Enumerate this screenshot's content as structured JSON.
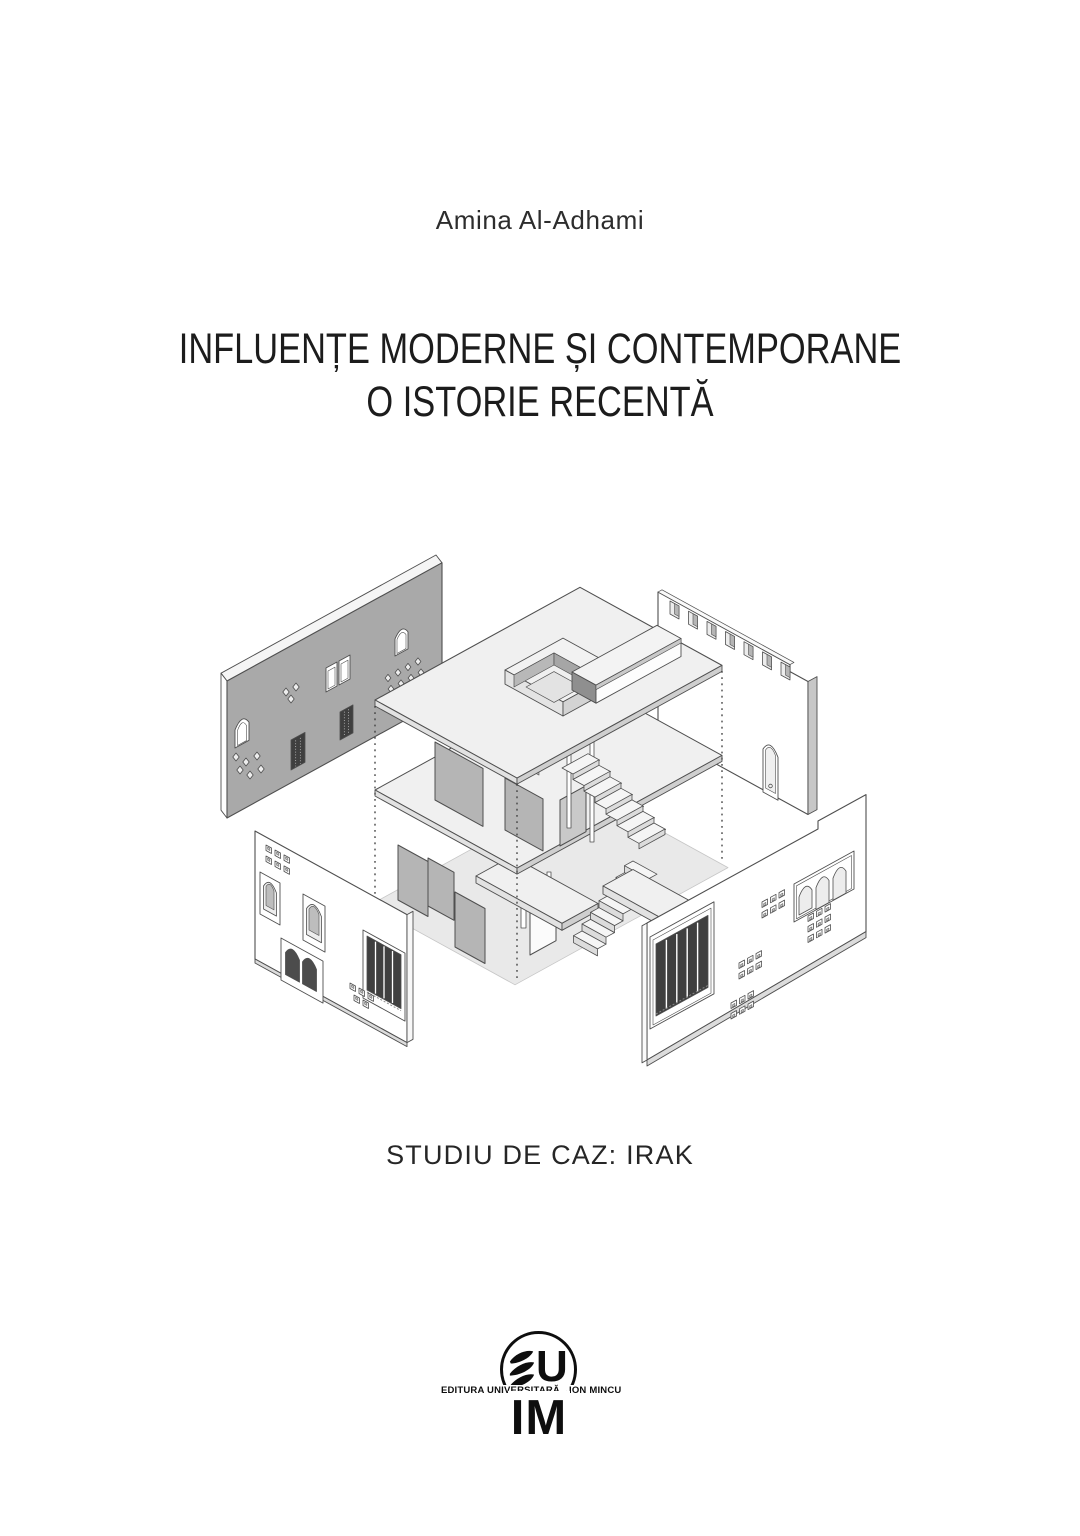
{
  "cover": {
    "author": "Amina Al-Adhami",
    "title_line1": "INFLUENȚE MODERNE ȘI CONTEMPORANE",
    "title_line2": "O ISTORIE RECENTĂ",
    "subtitle": "STUDIU DE CAZ: IRAK"
  },
  "publisher": {
    "name_left": "EDITURA UNIVERSITARĂ",
    "name_right": "ION MINCU",
    "monogram_top": "U",
    "monogram_bottom": "IM"
  },
  "figure": {
    "description": "Exploded axonometric drawing of a traditional courtyard house with four detached facade panels",
    "colors": {
      "line": "#4f4f4f",
      "panel_gray": "#a9a9a9",
      "partition": "#b5b5b5",
      "screen_dark": "#3f3f3f",
      "slab_top": "#f0f0f0",
      "slab_side": "#e2e2e2",
      "slab_side_dark": "#cfcfcf",
      "ground": "#e9e9e9",
      "white": "#ffffff"
    }
  }
}
